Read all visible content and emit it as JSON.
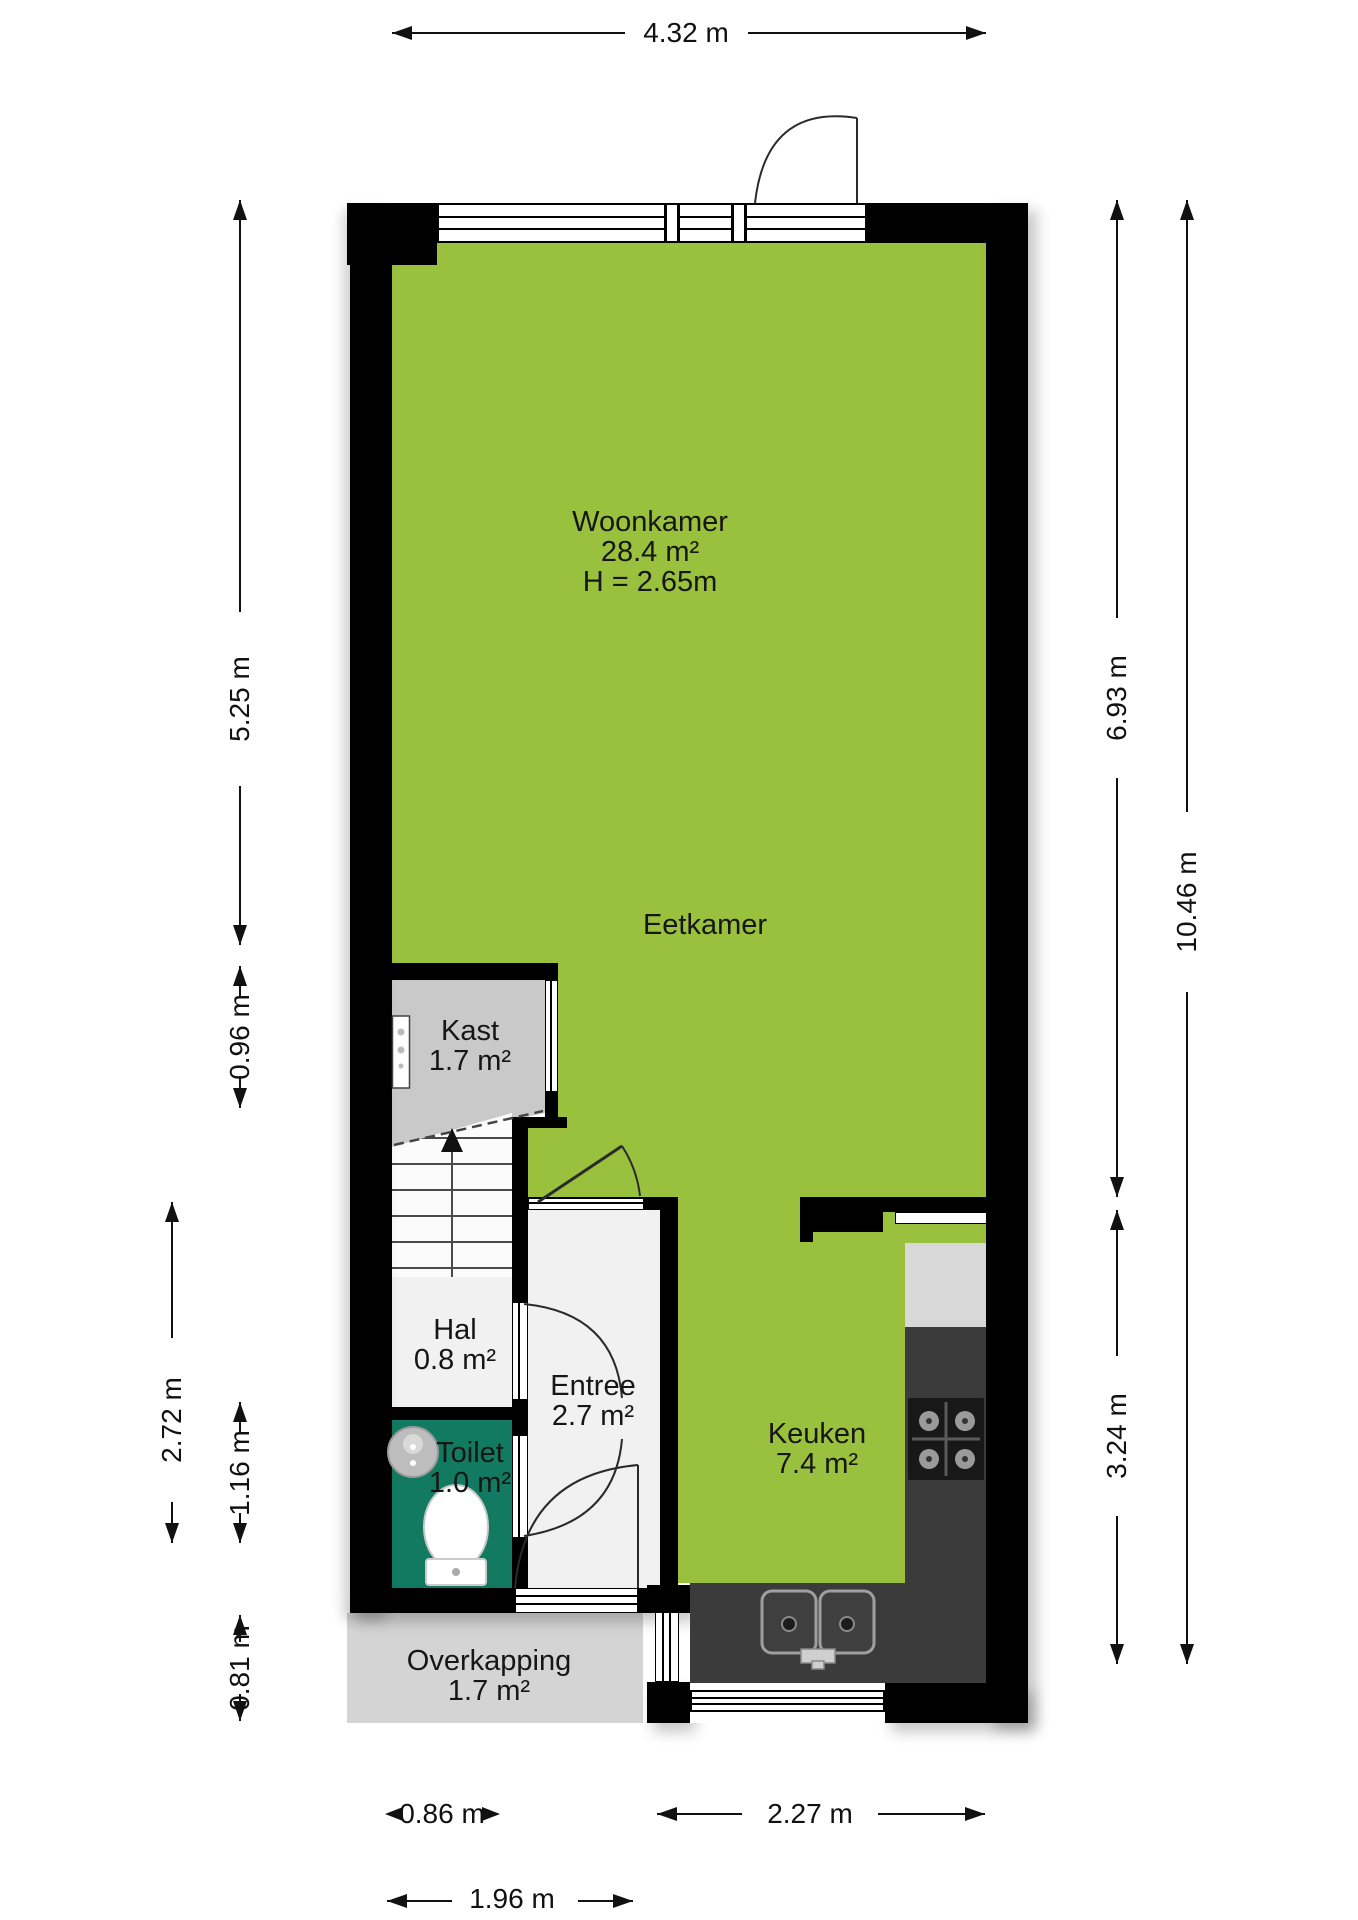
{
  "title": "Begane grond plattegrond",
  "rooms": {
    "woonkamer": {
      "label": "Woonkamer",
      "area": "28.4 m²",
      "height": "H = 2.65m"
    },
    "eetkamer": {
      "label": "Eetkamer"
    },
    "kast": {
      "label": "Kast",
      "area": "1.7 m²"
    },
    "hal": {
      "label": "Hal",
      "area": "0.8 m²"
    },
    "toilet": {
      "label": "Toilet",
      "area": "1.0 m²"
    },
    "entree": {
      "label": "Entree",
      "area": "2.7 m²"
    },
    "keuken": {
      "label": "Keuken",
      "area": "7.4 m²"
    },
    "overkapping": {
      "label": "Overkapping",
      "area": "1.7 m²"
    }
  },
  "dimensions": {
    "top_width": "4.32 m",
    "left_woonkamer": "5.25 m",
    "left_kast": "0.96 m",
    "left_outer": "2.72 m",
    "left_toilet": "1.16 m",
    "left_overkapping": "0.81 m",
    "right_upper": "6.93 m",
    "right_total": "10.46 m",
    "right_keuken": "3.24 m",
    "bottom_door": "0.86 m",
    "bottom_keuken": "2.27 m",
    "bottom_overkapping": "1.96 m"
  },
  "colors": {
    "floor_green": "#99C13D",
    "toilet_teal": "#117A60",
    "kast_gray": "#C9C9C9",
    "light_floor": "#F1F1F1",
    "overkapping_gray": "#D4D4D4",
    "counter_dark": "#3B3B3B",
    "wall_black": "#000000"
  }
}
